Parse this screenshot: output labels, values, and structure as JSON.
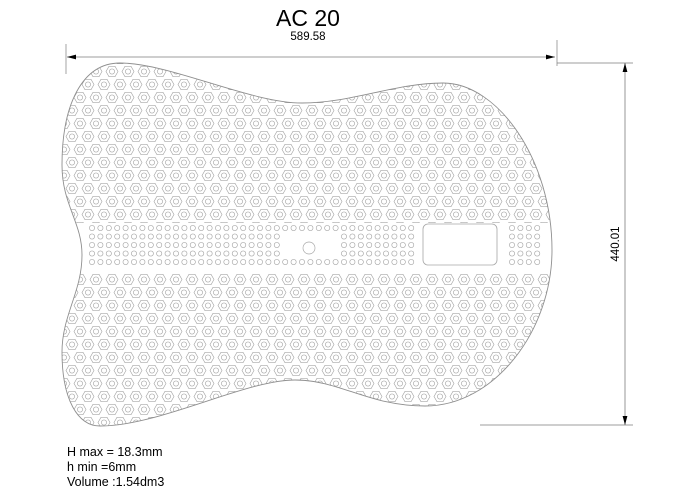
{
  "drawing": {
    "title": "AC 20",
    "width_dim": "589.58",
    "height_dim": "440.01",
    "notes": [
      "H max = 18.3mm",
      "h min =6mm",
      "Volume :1.54dm3"
    ]
  },
  "colors": {
    "background": "#ffffff",
    "outline": "#8f8f8f",
    "pattern": "#a6a6a6",
    "dimension": "#7d7d7d",
    "text": "#000000"
  }
}
